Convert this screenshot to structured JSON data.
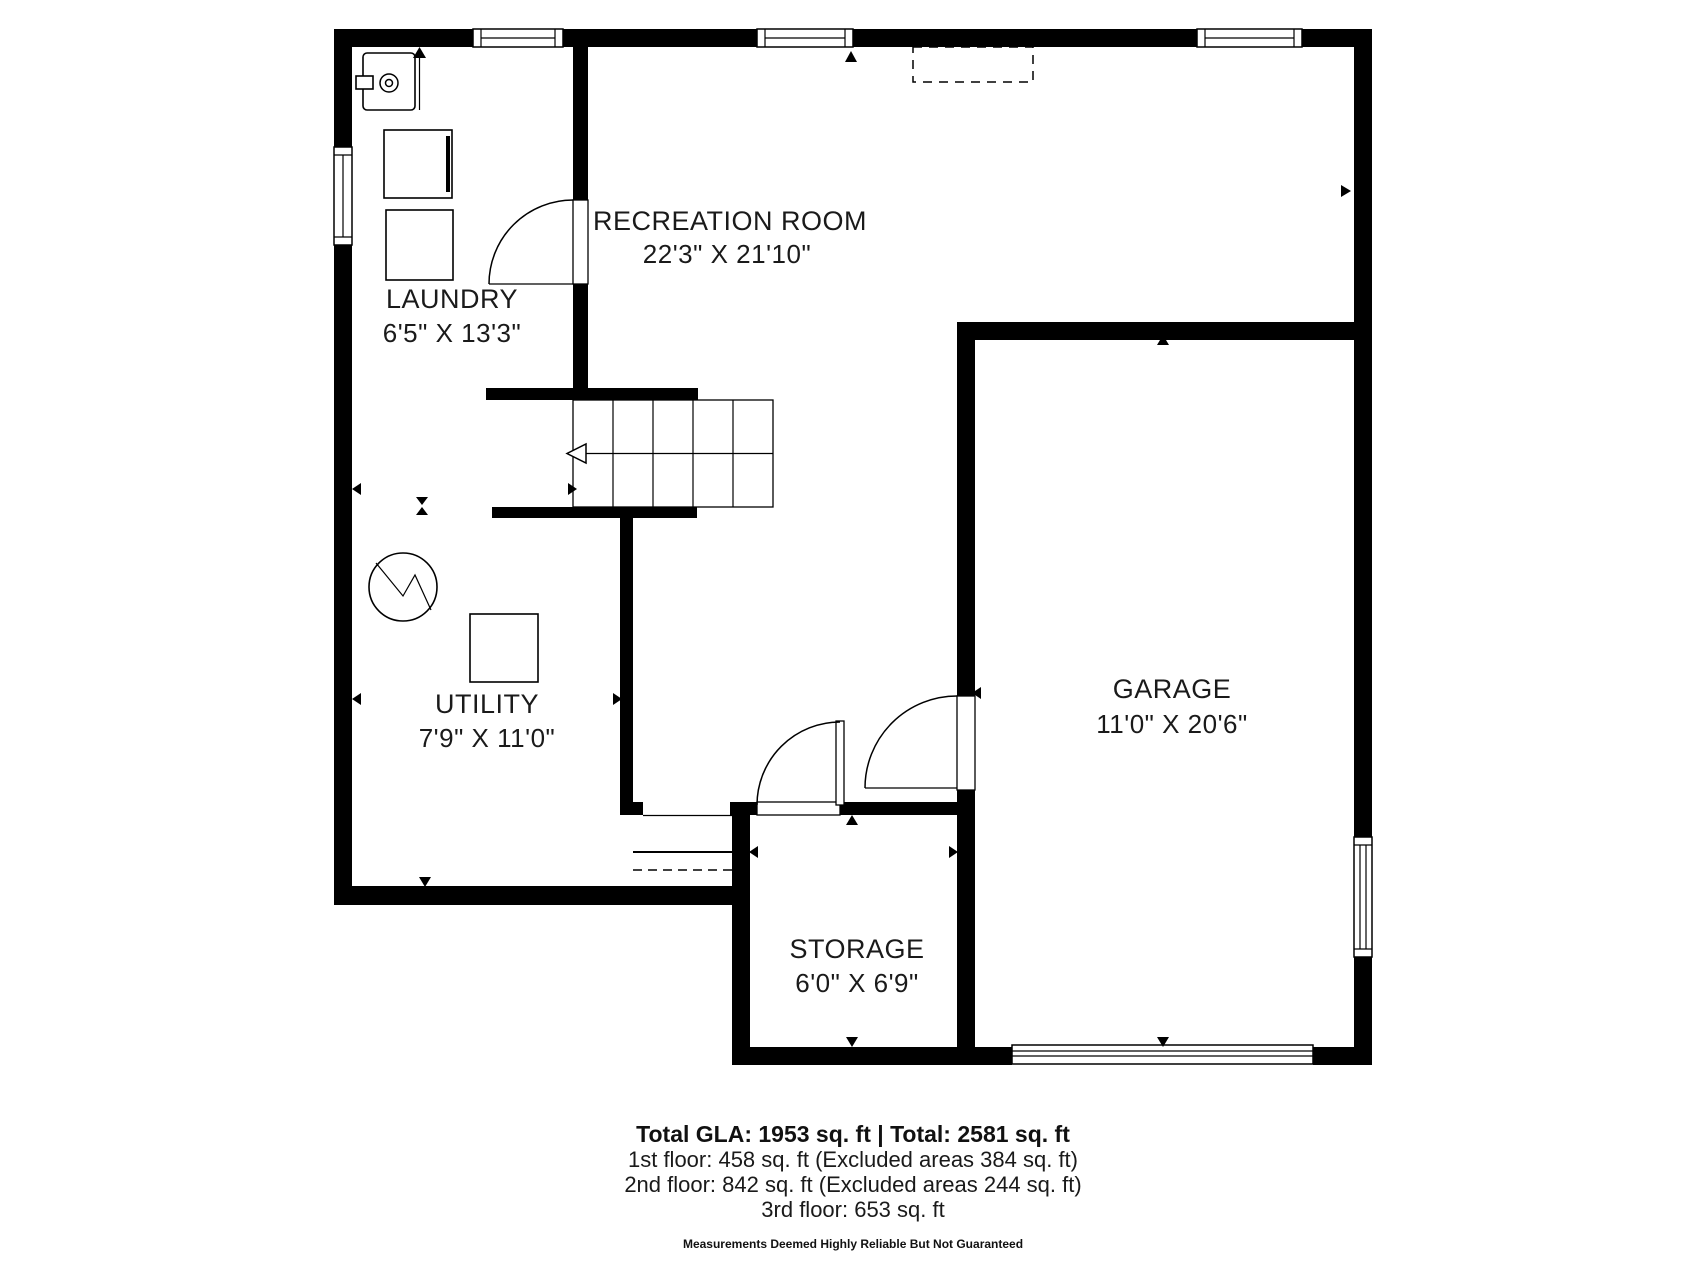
{
  "plan": {
    "rooms": {
      "laundry": {
        "name": "LAUNDRY",
        "dims": "6'5\" X 13'3\""
      },
      "recreation": {
        "name": "RECREATION ROOM",
        "dims": "22'3\" X 21'10\""
      },
      "utility": {
        "name": "UTILITY",
        "dims": "7'9\" X 11'0\""
      },
      "garage": {
        "name": "GARAGE",
        "dims": "11'0\" X 20'6\""
      },
      "storage": {
        "name": "STORAGE",
        "dims": "6'0\" X 6'9\""
      }
    }
  },
  "footer": {
    "totals": "Total GLA: 1953 sq. ft | Total: 2581 sq. ft",
    "floor1": "1st floor: 458 sq. ft (Excluded areas 384 sq. ft)",
    "floor2": "2nd floor: 842 sq. ft (Excluded areas 244 sq. ft)",
    "floor3": "3rd floor: 653 sq. ft",
    "disclaimer": "Measurements Deemed Highly Reliable But Not Guaranteed"
  },
  "colors": {
    "wall": "#000000",
    "background": "#ffffff",
    "text": "#1a1a1a"
  }
}
